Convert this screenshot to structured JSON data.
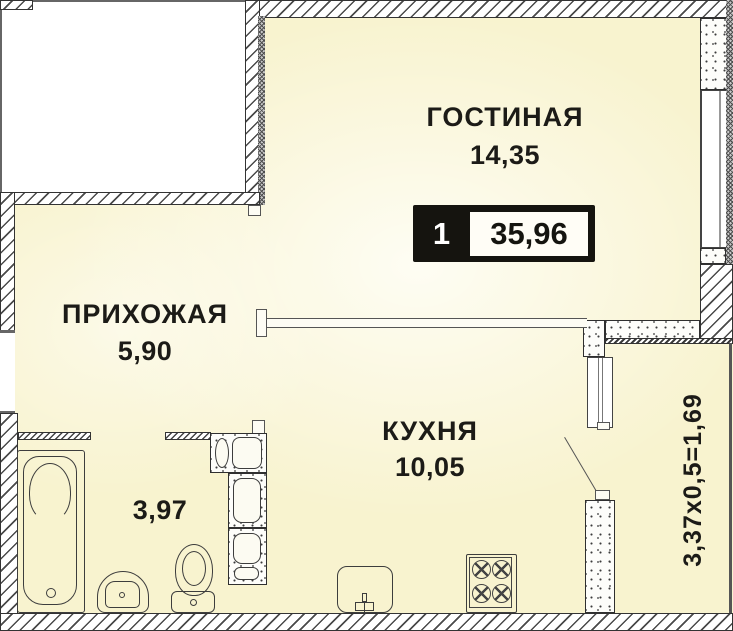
{
  "floorplan": {
    "rooms": {
      "living": {
        "label": "ГОСТИНАЯ",
        "area": "14,35"
      },
      "hallway": {
        "label": "ПРИХОЖАЯ",
        "area": "5,90"
      },
      "kitchen": {
        "label": "КУХНЯ",
        "area": "10,05"
      },
      "bathroom": {
        "area": "3,97"
      },
      "loggia": {
        "dimensions": "3,37х0,5=1,69"
      }
    },
    "badge": {
      "room_count": "1",
      "total_area": "35,96"
    },
    "fixtures": [
      "bathtub",
      "pedestal-sink",
      "toilet",
      "kitchen-sink",
      "stove",
      "vent-shaft",
      "balcony-door"
    ],
    "colors": {
      "room_fill": "#f8f3cf",
      "outline": "#333333",
      "badge_bg": "#15140f",
      "badge_text": "#ffffff",
      "label_text": "#1c1b17"
    }
  }
}
